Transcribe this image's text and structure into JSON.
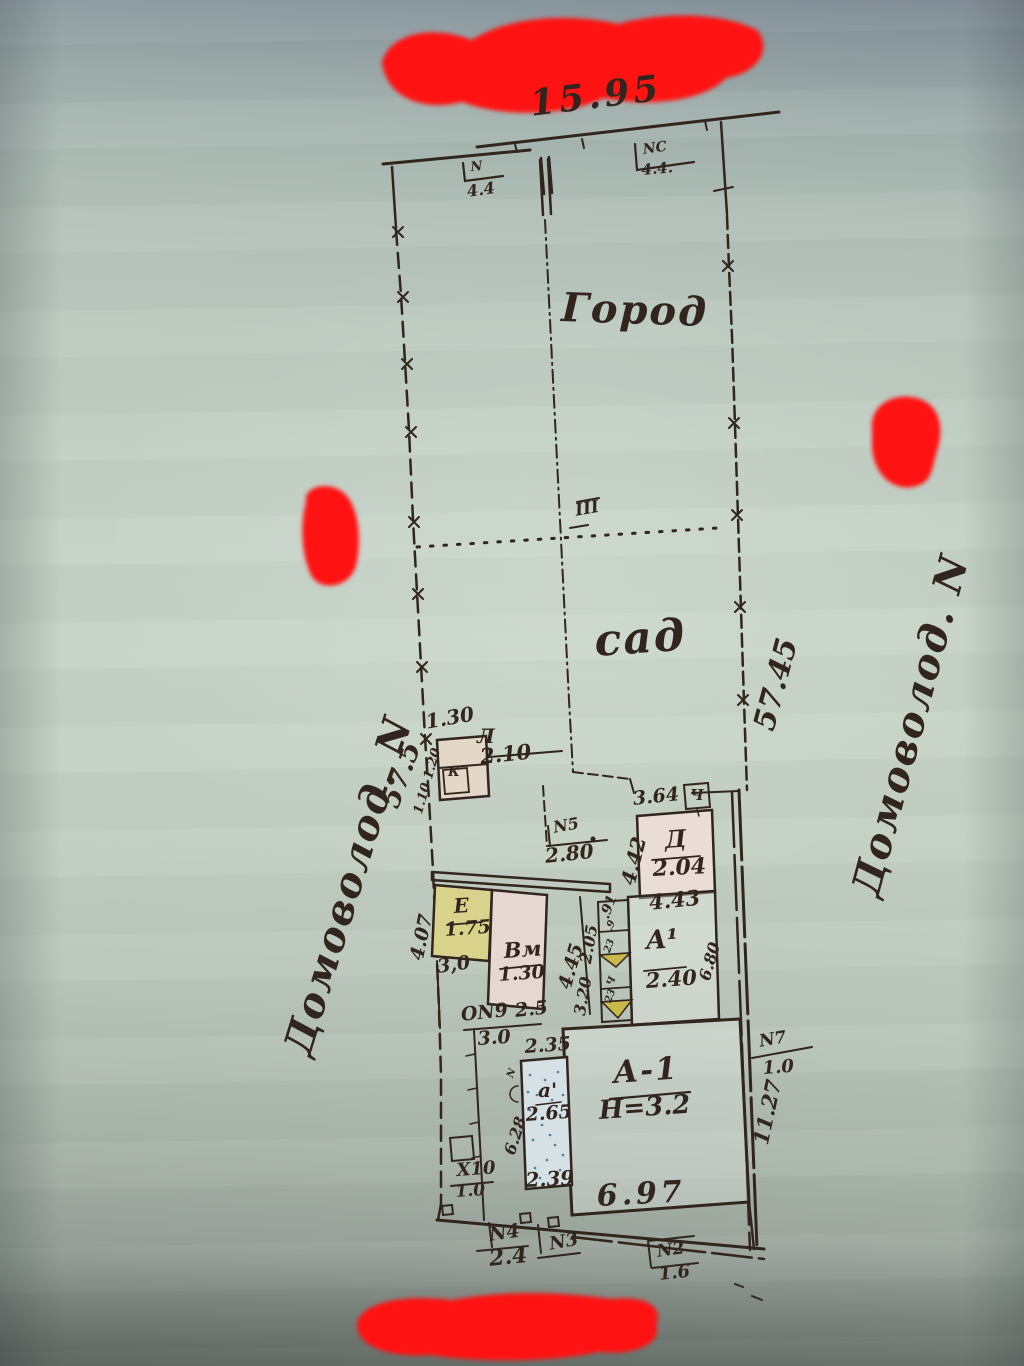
{
  "colors": {
    "ink": "#31251d",
    "redaction_red": "#ff1212",
    "paper_green": "#c7d3c7",
    "building_yellow": "#d9d28b",
    "building_pink": "#e6d8d1",
    "building_tan": "#e3d7c8",
    "porch_yellow": "#c9b94b",
    "stipple_blue": "#56789e"
  },
  "plan": {
    "street_frontage": "15.95",
    "left_boundary_length": "57.5",
    "right_boundary_length": "57.45",
    "vegetable_garden": "Город",
    "orchard": "сад",
    "section_mark": "III",
    "yard_dim": "3.0"
  },
  "handwritten_notes": {
    "left": "Домоволод. N",
    "right": "Домоволод. N"
  },
  "gates": {
    "n": {
      "label": "N",
      "dim": "4.4"
    },
    "nc": {
      "label": "NC",
      "dim": "4.4."
    },
    "n5": {
      "label": "N5",
      "dim": "2.80"
    },
    "n7": {
      "label": "N7",
      "dim": "1.0"
    },
    "n9": {
      "label": "ОN9",
      "dim": "2.5"
    },
    "x10": {
      "label": "X10",
      "dim": "1.0"
    },
    "n4": {
      "label": "N4",
      "dim": "2.4"
    },
    "n3": {
      "label": "N3"
    },
    "n2": {
      "label": "N2",
      "dim": "1.6"
    }
  },
  "buildings": {
    "l": {
      "label": "Л",
      "height": "2.10",
      "top_dim": "1.30",
      "side_dims": "1.10 1.20",
      "inner_mark": "К"
    },
    "e": {
      "label": "Е",
      "height": "1.75",
      "below_dim": "3,0",
      "left_dim": "4.07"
    },
    "vm": {
      "label": "Вм",
      "height": "1.30",
      "right_dim": "4.45"
    },
    "d": {
      "label": "Д",
      "height": "2.04",
      "top_dim": "3.64",
      "left_dim": "4.42",
      "box_mark": "Ч"
    },
    "a1_annex": {
      "label": "А¹",
      "height": "2.40",
      "top_dim": "4.43",
      "right_dim": "6.80",
      "upper_left_dim": "2.05",
      "lower_left_dim": "3.20",
      "corner_dim": ".91",
      "porch_cells": [
        ".9",
        "23",
        "Ч",
        "23"
      ]
    },
    "a1": {
      "label": "А-1",
      "height_note": "Н=3.2",
      "bottom_dim": "6.97",
      "right_dim": "11.27"
    },
    "a_small": {
      "label": "а'",
      "height": "2.65",
      "top_dim": "2.35",
      "bottom_dim": "2.39",
      "left_dim": "6.28",
      "side_mark": "N"
    }
  }
}
